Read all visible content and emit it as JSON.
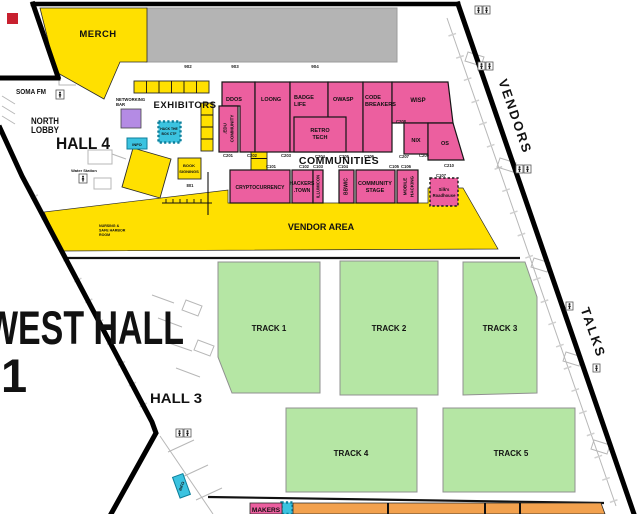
{
  "colors": {
    "yellow": "#FFE000",
    "pink": "#EC5F9F",
    "green": "#B5E6A4",
    "gray": "#B4B4B4",
    "purple": "#B48BE4",
    "cyan": "#3BC3E0",
    "orange": "#F2A14E",
    "red": "#C8202F"
  },
  "halls": {
    "west_hall_line1": "WEST HALL",
    "west_hall_line2": "1",
    "hall_4": "HALL 4",
    "hall_3": "HALL 3",
    "north_lobby": [
      "NORTH",
      "LOBBY"
    ]
  },
  "side_labels": {
    "vendors": "VENDORS",
    "talks": "TALKS"
  },
  "areas": {
    "merch": "MERCH",
    "soma_fm": "SOMA FM",
    "exhibitors": "EXHIBITORS",
    "vendor_area": "VENDOR AREA",
    "communities_heading": "COMMUNITIES",
    "makers": "MAKERS",
    "networking_bar": [
      "NETWORKING",
      "BAR"
    ],
    "book_signings": [
      "BOOK",
      "SIGNINGS"
    ],
    "hack_the_box": [
      "HACK THE",
      "BOX CTF"
    ],
    "info_booth": "INFO",
    "water_station": "Water Station",
    "nursing_room": [
      "NURSING &",
      "SAFE HARBOR",
      "ROOM"
    ]
  },
  "booth_numbers": {
    "n902": "902",
    "n903": "903",
    "n904": "904",
    "n801": "801"
  },
  "tracks": [
    "TRACK 1",
    "TRACK 2",
    "TRACK 3",
    "TRACK 4",
    "TRACK 5"
  ],
  "communities": {
    "codes_top": [
      "C201",
      "C202",
      "C203",
      "C204",
      "C205",
      "C206",
      "C207",
      "C208",
      "C209",
      "C210"
    ],
    "codes_bottom": [
      "C101",
      "C102",
      "C103",
      "C104",
      "C105",
      "C106",
      "C107"
    ],
    "edu": [
      ".EDU",
      "COMMUNITY"
    ],
    "ddos": "DDOS",
    "loong": "LOONG",
    "badge_life": [
      "BADGE",
      "LIFE"
    ],
    "retro_tech": [
      "RETRO",
      "TECH"
    ],
    "owasp": "OWASP",
    "code_breakers": [
      "CODE",
      "BREAKERS"
    ],
    "wisp": "WISP",
    "nix": "NIX",
    "os": "OS",
    "cryptocurrency": "CRYPTOCURRENCY",
    "hackers_town": [
      "HACKERS",
      ".TOWN"
    ],
    "illumicon": "ILLUMICON",
    "bbwic": "BBWIC",
    "community_stage": [
      "COMMUNITY",
      "STAGE"
    ],
    "mobile_hacking": [
      "MOBILE",
      "HACKING"
    ],
    "silks_roadhouse": [
      "Silk's",
      "Roadhouse"
    ]
  }
}
